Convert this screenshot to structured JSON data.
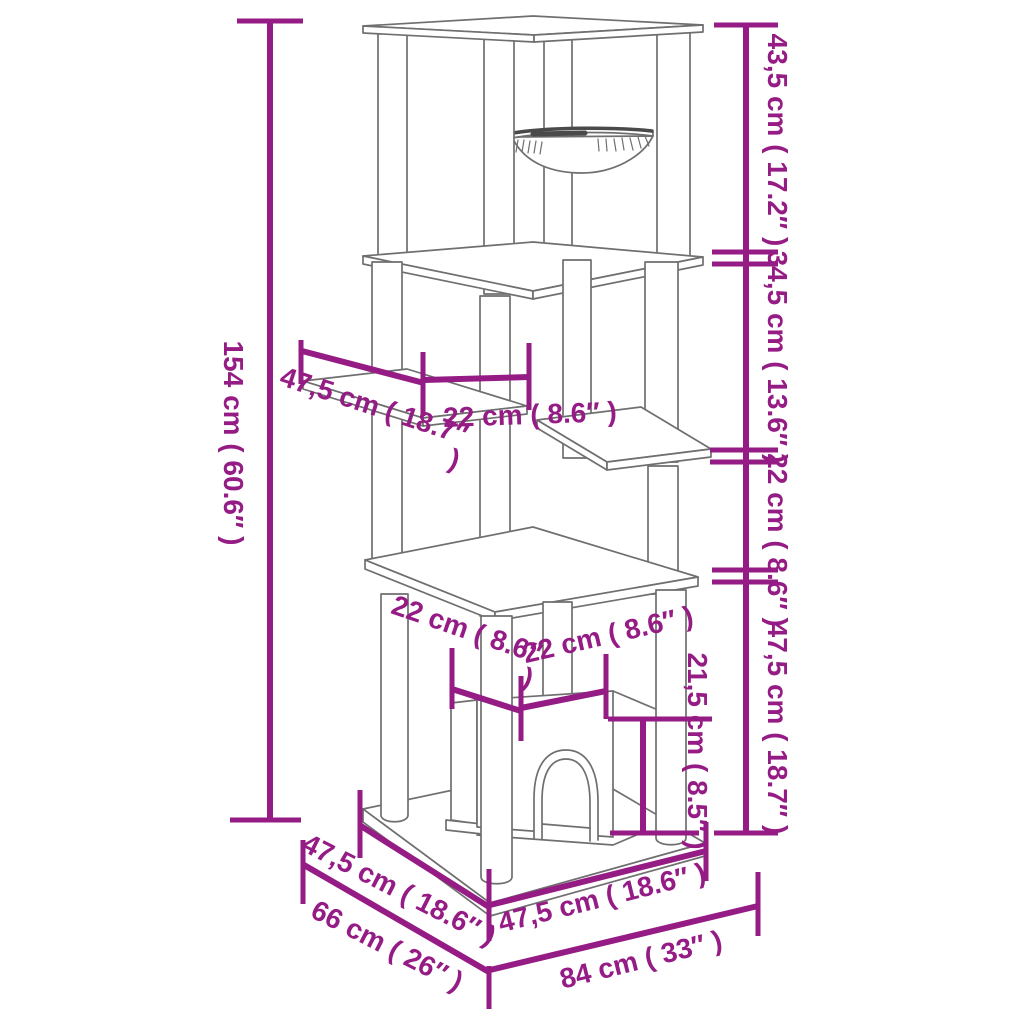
{
  "page": {
    "background": "#ffffff",
    "kind": "product-dimension-diagram",
    "subject": "cat tree with scratching posts, hammock, perches and cat house"
  },
  "colors": {
    "dimension": "#951b85",
    "sketch": "#6f6f6f",
    "sketch_dark": "#4a4a4a"
  },
  "dimensions": {
    "total_height": "154 cm ( 60.6″ )",
    "section_top": "43,5 cm ( 17.2″ )",
    "section_upper_mid": "34,5 cm ( 13.6″ )",
    "section_lower_mid": "22 cm ( 8.6″ )",
    "section_bottom": "47,5 cm ( 18.7″ )",
    "perch_length": "47,5 cm ( 18.7″ )",
    "perch_width": "22 cm ( 8.6″ )",
    "house_side": "22 cm ( 8.6″ )",
    "house_front": "22 cm ( 8.6″ )",
    "house_height": "21,5 cm ( 8.5″ )",
    "base_side": "47,5 cm ( 18.6″ )",
    "base_depth": "66 cm ( 26″ )",
    "base_front": "47,5 cm ( 18.6″ )",
    "base_width": "84 cm ( 33″ )"
  }
}
